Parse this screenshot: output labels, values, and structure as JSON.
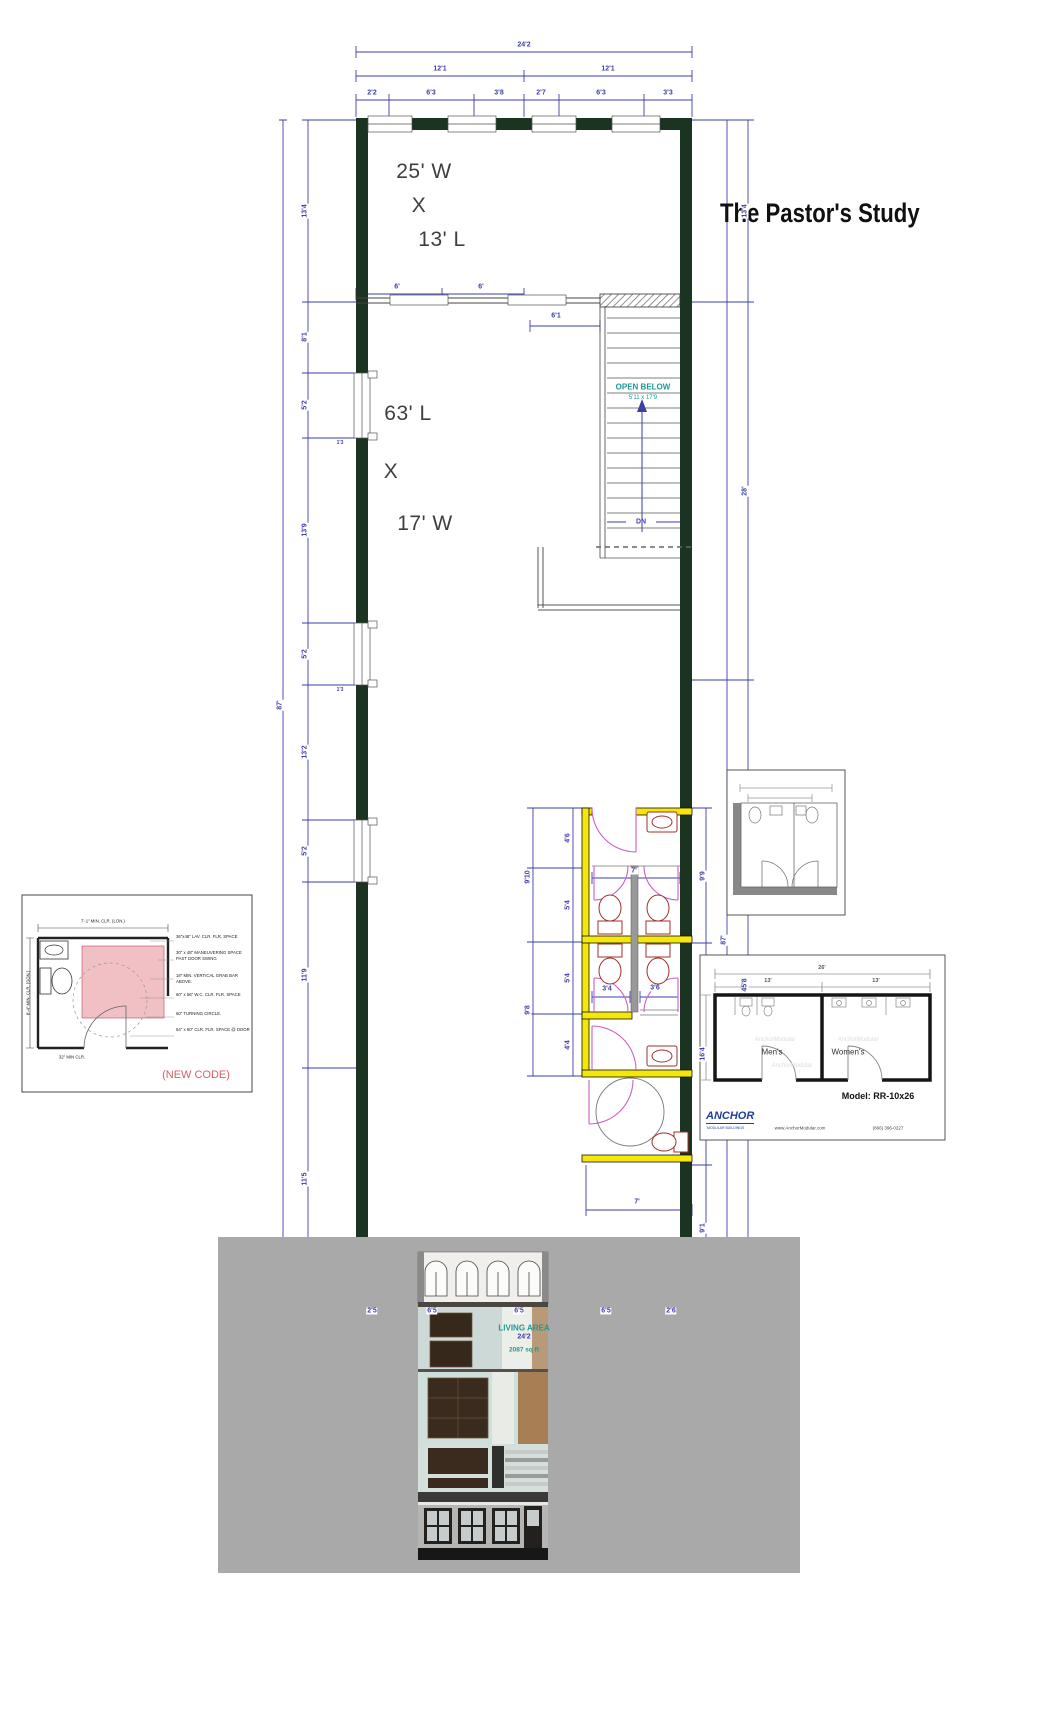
{
  "title": "The Pastor's Study",
  "room_labels": {
    "upper": {
      "line1": "25' W",
      "line2": "X",
      "line3": "13' L"
    },
    "main": {
      "line1": "63' L",
      "line2": "X",
      "line3": "17' W"
    }
  },
  "stairs": {
    "open_below": "OPEN BELOW",
    "opening_size": "5'11 x 17'9",
    "dn": "DN"
  },
  "living_area": {
    "label": "LIVING AREA",
    "width": "24'2",
    "area": "2087 sq ft"
  },
  "dims": {
    "top": {
      "overall": "24'2",
      "left_half": "12'1",
      "right_half": "12'1",
      "segments": [
        "2'2",
        "6'3",
        "3'8",
        "2'7",
        "6'3",
        "3'3"
      ]
    },
    "bottom": {
      "segments": [
        "2'5",
        "6'5",
        "6'5",
        "6'5",
        "2'6"
      ]
    },
    "left": {
      "overall": "87'",
      "segments": [
        "13'4",
        "8'1",
        "5'2",
        "13'9",
        "5'2",
        "13'2",
        "5'2",
        "11'9",
        "11'5"
      ],
      "window_a": "1'3",
      "window_b": "1'3"
    },
    "right": {
      "overall": "87'",
      "segments": [
        "13'4",
        "28'",
        "45'8"
      ],
      "bath_segments": [
        "9'9",
        "16'4",
        "9'1"
      ]
    },
    "opening": {
      "segments": [
        "6'",
        "6'",
        "6'1"
      ]
    },
    "bath": {
      "outer": [
        "9'10",
        "9'8"
      ],
      "inner": [
        "4'6",
        "5'4",
        "5'4",
        "4'4"
      ],
      "stall_width": "7'",
      "stall_a": "3'4",
      "stall_b": "3'6",
      "ada_width": "7'"
    }
  },
  "ada_inset": {
    "top_note": "7'-1\" MIN. CLR. (LON.)",
    "side_note": "8'-4\" MIN. CLR. (SON.)",
    "notes": [
      "36\"x48\" LAV. CLR. FLR. SPACE",
      "30\" x 48\" MANEUVERING SPACE PAST DOOR SWING",
      "18\" MIN. VERTICAL GRAB BAR ABOVE.",
      "60\" x 56\" W.C. CLR. FLR. SPACE",
      "60\" TURNING CIRCLE.",
      "54\" x 60\" CLR. FLR. SPACE @ DOOR"
    ],
    "bottom_note": "32\" MIN CLR.",
    "stamp": "(NEW CODE)"
  },
  "model_inset": {
    "width": "26'",
    "left_width": "13'",
    "right_width": "13'",
    "mens": "Men's",
    "womens": "Women's",
    "model": "Model: RR-10x26",
    "brand": "ANCHOR",
    "brand_sub": "MODULAR BUILDINGS",
    "website": "www.AnchorModular.com",
    "phone": "(866) 396-0227",
    "watermark": "AnchorModular"
  }
}
